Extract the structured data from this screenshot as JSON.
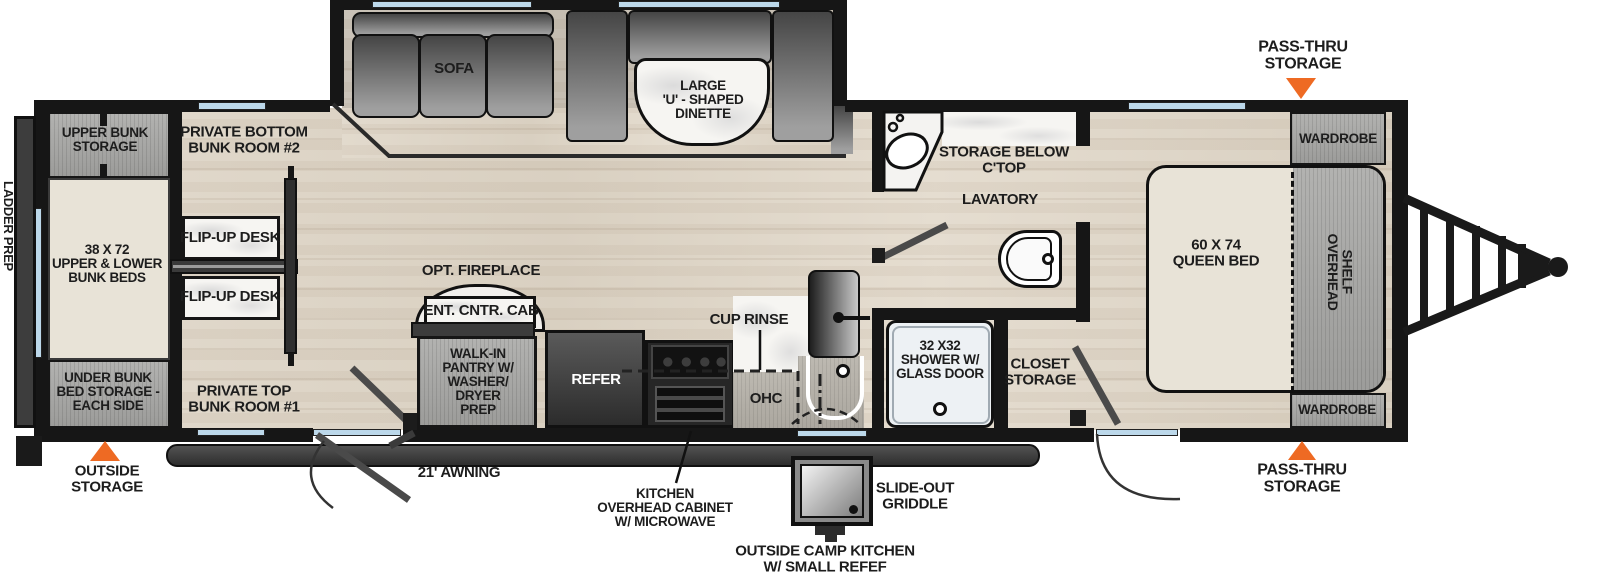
{
  "floorplan": {
    "colors": {
      "accent_orange": "#ee6a23",
      "window_blue": "#bcd8ea",
      "wall": "#161616"
    },
    "exterior": {
      "pass_thru_storage_top": "PASS-THRU\nSTORAGE",
      "pass_thru_storage_bottom": "PASS-THRU\nSTORAGE",
      "outside_storage": "OUTSIDE\nSTORAGE",
      "awning": "21' AWNING",
      "kitchen_overhead_cabinet": "KITCHEN\nOVERHEAD CABINET\nW/ MICROWAVE",
      "slide_out_griddle": "SLIDE-OUT\nGRIDDLE",
      "outside_camp_kitchen": "OUTSIDE CAMP KITCHEN\nW/ SMALL REFEF",
      "ladder_prep": "LADDER PREP"
    },
    "bedroom": {
      "wardrobe_top": "WARDROBE",
      "wardrobe_bottom": "WARDROBE",
      "queen_bed": "60 X 74\nQUEEN BED",
      "overhead_shelf": "OVERHEAD\nSHELF"
    },
    "bathroom": {
      "storage_below_ctop": "STORAGE BELOW\nC'TOP",
      "lavatory": "LAVATORY",
      "shower": "32 X32\nSHOWER W/\nGLASS DOOR",
      "closet_storage": "CLOSET\nSTORAGE"
    },
    "kitchen": {
      "cup_rinse": "CUP RINSE",
      "ohc": "OHC",
      "refer": "REFER",
      "walk_in_pantry": "WALK-IN\nPANTRY W/\nWASHER/\nDRYER\nPREP",
      "ent_cntr_cab": "ENT. CNTR. CAB",
      "opt_fireplace": "OPT. FIREPLACE"
    },
    "living": {
      "sofa": "SOFA",
      "dinette": "LARGE\n'U' - SHAPED\nDINETTE"
    },
    "bunk_area": {
      "upper_bunk_storage": "UPPER BUNK\nSTORAGE",
      "bunk_beds": "38 X 72\nUPPER & LOWER\nBUNK BEDS",
      "under_bunk_storage": "UNDER BUNK\nBED STORAGE -\nEACH SIDE",
      "private_bottom_bunk_room": "PRIVATE BOTTOM\nBUNK ROOM #2",
      "private_top_bunk_room": "PRIVATE TOP\nBUNK ROOM #1",
      "flip_up_desk_1": "FLIP-UP DESK",
      "flip_up_desk_2": "FLIP-UP DESK"
    }
  }
}
